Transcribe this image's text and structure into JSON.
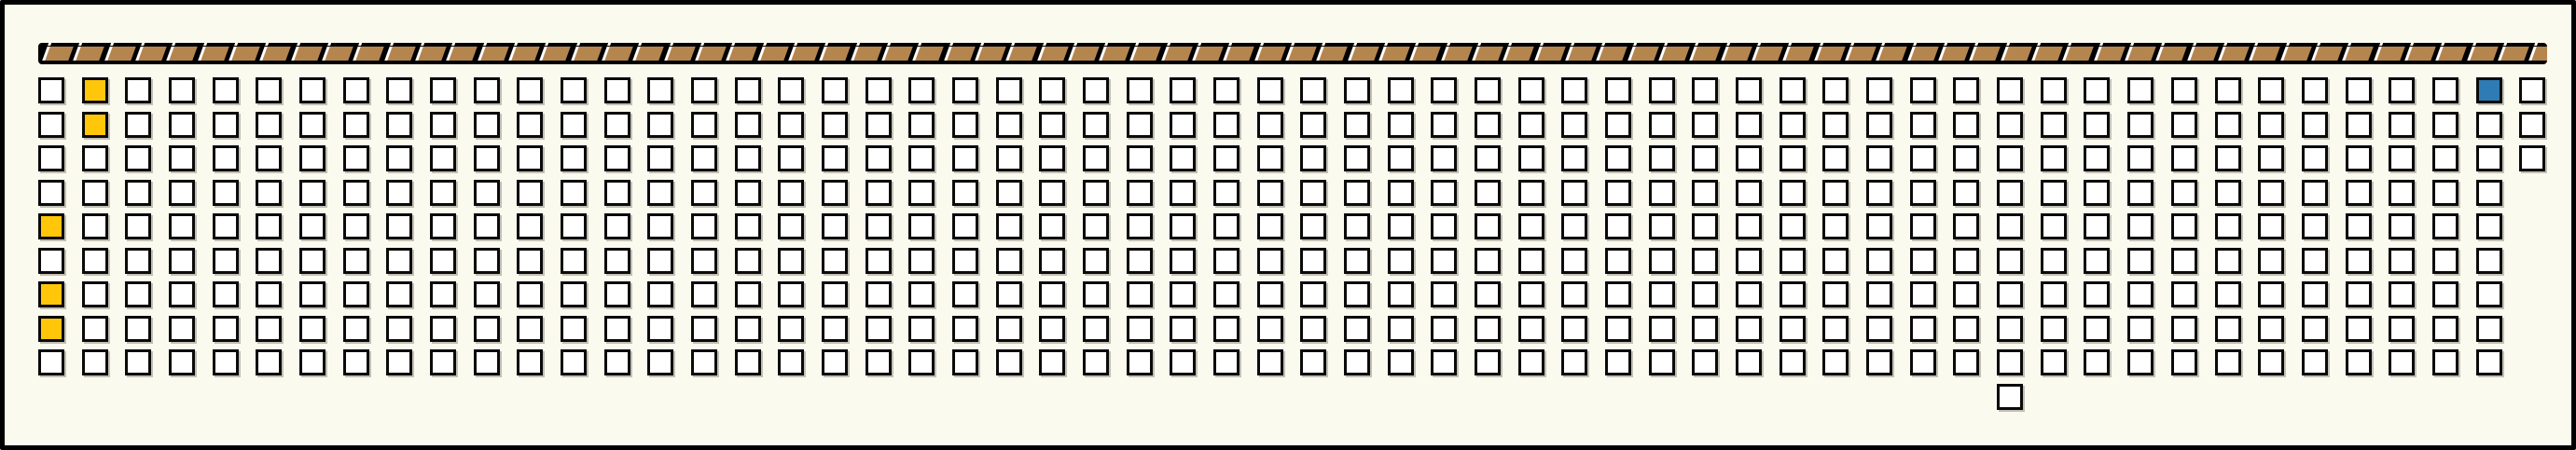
{
  "scene": {
    "background_color": "#FBFAEE",
    "frame_color": "#000000"
  },
  "top_strip": {
    "segment_count": 81,
    "band_color": "#000000",
    "segment_color": "#B5854E",
    "separator_color": "#FFFFFF"
  },
  "grid": {
    "rows": 9,
    "columns": 58,
    "cell_default_color": "#FFFFFF",
    "cell_border_color": "#0A0A0A",
    "missing_cells": [
      {
        "row": 4,
        "col": 58
      },
      {
        "row": 5,
        "col": 58
      },
      {
        "row": 6,
        "col": 58
      },
      {
        "row": 7,
        "col": 58
      },
      {
        "row": 8,
        "col": 58
      },
      {
        "row": 9,
        "col": 58
      }
    ],
    "extra_cells": [
      {
        "row": 10,
        "col": 46
      }
    ],
    "highlighted_cells": [
      {
        "row": 1,
        "col": 2,
        "color": "#FFC60A",
        "color_name": "yellow"
      },
      {
        "row": 2,
        "col": 2,
        "color": "#FFC60A",
        "color_name": "yellow"
      },
      {
        "row": 5,
        "col": 1,
        "color": "#FFC60A",
        "color_name": "yellow"
      },
      {
        "row": 7,
        "col": 1,
        "color": "#FFC60A",
        "color_name": "yellow"
      },
      {
        "row": 8,
        "col": 1,
        "color": "#FFC60A",
        "color_name": "yellow"
      },
      {
        "row": 1,
        "col": 57,
        "color": "#2E7BB6",
        "color_name": "blue"
      }
    ]
  }
}
